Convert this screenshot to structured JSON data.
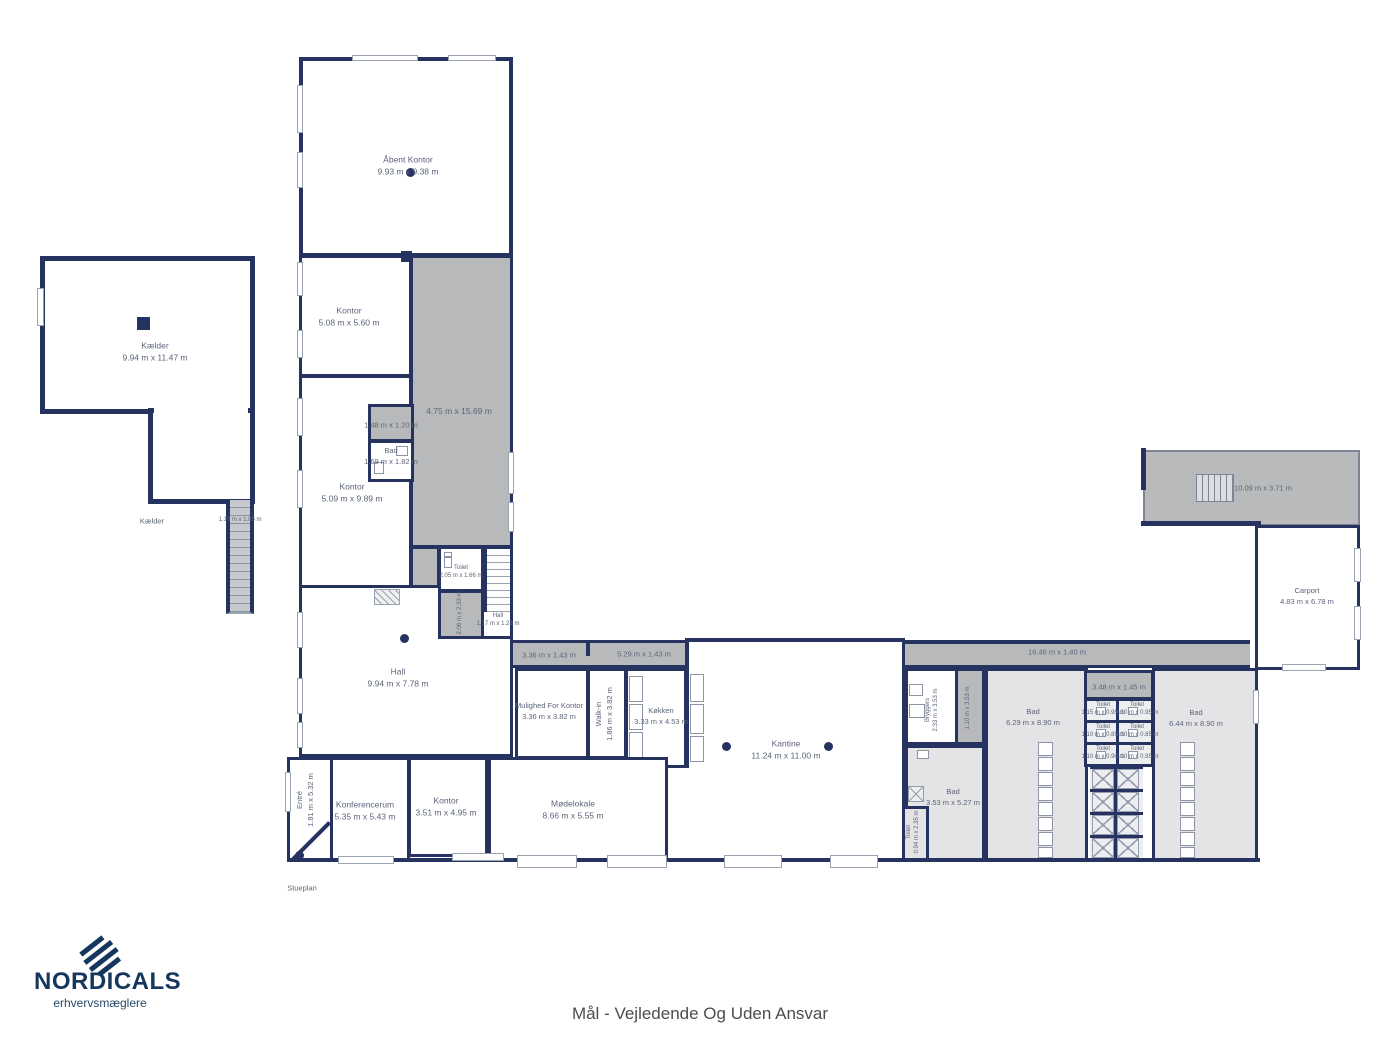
{
  "colors": {
    "wall": "#26325f",
    "corridor_gray": "#b8b9bb",
    "room_gray": "#e4e4e7",
    "logo_navy": "#15375e"
  },
  "footer": {
    "stueplan": "Stueplan",
    "caption": "Mål - Vejledende Og Uden Ansvar"
  },
  "logo": {
    "name": "NORDICALS",
    "tagline": "erhvervsmæglere"
  },
  "rooms": {
    "open_office": {
      "name": "Åbent Kontor",
      "dims": "9.93 m x 9.38 m"
    },
    "office1": {
      "name": "Kontor",
      "dims": "5.08 m x 5.60 m"
    },
    "hall_strip": {
      "dims": "4.75 m x 15.69 m"
    },
    "office2": {
      "name": "Kontor",
      "dims": "5.09 m x 9.89 m"
    },
    "store_small": {
      "dims": "1.48 m x 1.20 m"
    },
    "bath_small": {
      "name": "Bad",
      "dims": "1.69 m x 1.82 m"
    },
    "basement": {
      "name": "Kælder",
      "dims": "9.94 m x 11.47 m"
    },
    "basement_tag": {
      "name": "Kælder"
    },
    "basement_stairs": {
      "dims": "1.10 m x 1.85 m"
    },
    "toilet_mid": {
      "name": "Toilet",
      "dims": "2.05 m x 1.66 m"
    },
    "room_mid": {
      "dims": "2.06 m x 2.33 m"
    },
    "hall_small": {
      "name": "Hall",
      "dims": "1.17 m x 1.26 m"
    },
    "hall_main": {
      "name": "Hall",
      "dims": "9.94 m x 7.78 m"
    },
    "corridor1": {
      "dims": "3.36 m x 1.43 m"
    },
    "corridor2": {
      "dims": "5.29 m x 1.43 m"
    },
    "corridor3": {
      "dims": "16.46 m x 1.40 m"
    },
    "office_option": {
      "name": "Mulighed For Kontor",
      "dims": "3.36 m x 3.82 m"
    },
    "walk_in": {
      "name": "Walk-in",
      "dims": "1.86 m x 3.82 m"
    },
    "kitchen": {
      "name": "Køkken",
      "dims": "3.33 m x 4.53 m"
    },
    "canteen": {
      "name": "Kantine",
      "dims": "11.24 m x 11.00 m"
    },
    "entry": {
      "name": "Entré",
      "dims": "1.81 m x 5.32 m"
    },
    "conference": {
      "name": "Konferencerum",
      "dims": "5.35 m x 5.43 m"
    },
    "office3": {
      "name": "Kontor",
      "dims": "3.51 m x 4.95 m"
    },
    "meeting": {
      "name": "Mødelokale",
      "dims": "8.66 m x 5.55 m"
    },
    "utility": {
      "name": "Bryggers",
      "dims": "2.33 m x 3.53 m"
    },
    "corridor4": {
      "dims": "1.10 m x 3.53 m"
    },
    "bath1": {
      "name": "Bad",
      "dims": "6.29 m x 8.90 m"
    },
    "toilet_top": {
      "dims": "3.48 m x 1.45 m"
    },
    "toilet1": {
      "name": "Toilet",
      "dims": "1.15 m x 0.95 m"
    },
    "toilet2": {
      "name": "Toilet",
      "dims": "1.10 m x 0.95 m"
    },
    "toilet3": {
      "name": "Toilet",
      "dims": "1.10 m x 0.85 m"
    },
    "toilet4": {
      "name": "Toilet",
      "dims": "1.10 m x 0.85 m"
    },
    "toilet5": {
      "name": "Toilet",
      "dims": "1.10 m x 0.90 m"
    },
    "toilet6": {
      "name": "Toilet",
      "dims": "1.10 m x 0.95 m"
    },
    "bath2": {
      "name": "Bad",
      "dims": "6.44 m x 8.90 m"
    },
    "bath3": {
      "name": "Bad",
      "dims": "3.53 m x 5.27 m"
    },
    "toilet7": {
      "name": "Toilet",
      "dims": "0.94 m x 2.35 m"
    },
    "roof": {
      "dims": "10.09 m x 3.71 m"
    },
    "carport": {
      "name": "Carport",
      "dims": "4.83 m x 6.78 m"
    }
  }
}
